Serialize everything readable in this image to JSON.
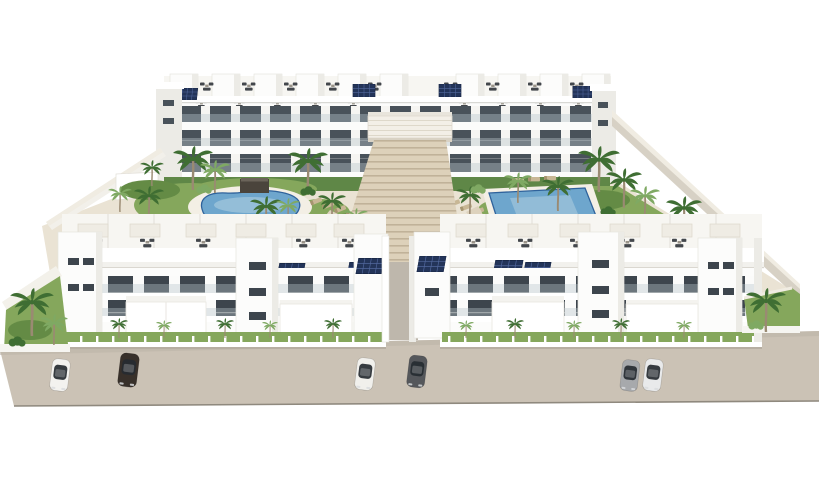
{
  "scene_description": "Aerial 3D architectural rendering of a white Mediterranean-style apartment complex: two rows of flat-roofed residential blocks with rooftop terraces and solar panels, a landscaped inner courtyard with an organic-shaped pool, a rectangular pool, a wide central staircase, palm trees, perimeter walls, and six cars parked on the beige street in front.",
  "colors": {
    "sky": "#ffffff",
    "building_white": "#fcfcfb",
    "building_light": "#f7f6f2",
    "building_shade": "#ecebe6",
    "window_dark": "#49525a",
    "window_front": "#3d454d",
    "glass": "#b9c6cc",
    "solar": "#233459",
    "solar_grid": "#51679c",
    "deck": "#eae3d4",
    "pool_deck": "#f3efe5",
    "stairs": "#ddd1ba",
    "stair_line": "#c0b299",
    "lawn": "#85a75c",
    "lawn_dark": "#648b45",
    "hedge": "#5f8747",
    "palm_dark": "#3f6e33",
    "palm_light": "#7fa963",
    "trunk": "#9a8a72",
    "wall_top": "#f0ece2",
    "wall_face": "#d7d1c5",
    "street": "#cbc2b5",
    "street_edge": "#8f897e",
    "gazebo": "#4a443c",
    "furniture": "#43474c",
    "lounger": "#c8b795",
    "pool_mid": "#6ea6cd",
    "pool_light": "#b5d2e2",
    "pool_rim": "#2f629b"
  },
  "scene": {
    "back_buildings": {
      "blocks": 2,
      "floors": 3,
      "rooftop_penthouses": 10
    },
    "front_buildings": {
      "blocks": 2,
      "floors": 3,
      "rooftop_terraces": 12
    },
    "pools": [
      {
        "name": "organic free-form pool"
      },
      {
        "name": "rectangular pool"
      }
    ],
    "central_staircase": true,
    "solar_panels": true,
    "cars": [
      {
        "color": "#f3f2ef"
      },
      {
        "color": "#38302a"
      },
      {
        "color": "#f1f0ec"
      },
      {
        "color": "#55575b"
      },
      {
        "color": "#a7a9ac"
      },
      {
        "color": "#e9eaeb"
      }
    ]
  }
}
